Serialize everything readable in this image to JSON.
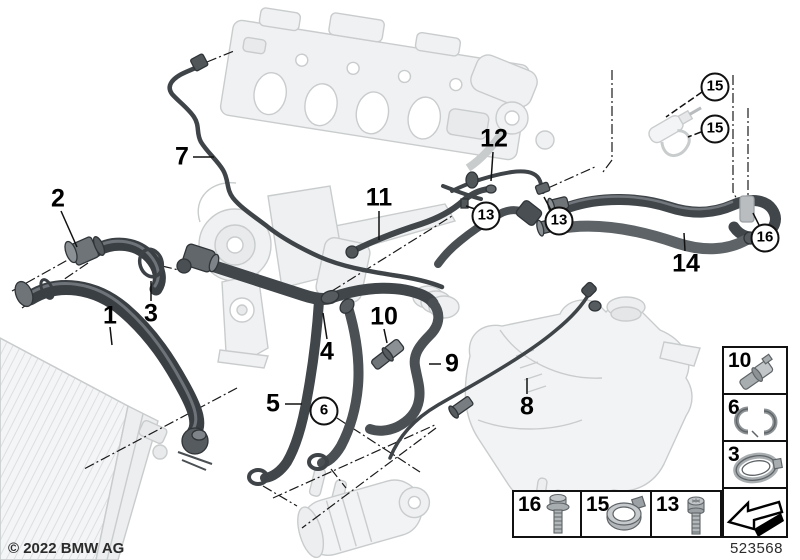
{
  "diagram": {
    "copyright": "© 2022 BMW AG",
    "drawing_number": "523568",
    "callouts": [
      {
        "label": "1",
        "x": 110,
        "y": 316,
        "circled": false
      },
      {
        "label": "2",
        "x": 58,
        "y": 199,
        "circled": false
      },
      {
        "label": "3",
        "x": 151,
        "y": 314,
        "circled": false
      },
      {
        "label": "4",
        "x": 327,
        "y": 352,
        "circled": false
      },
      {
        "label": "5",
        "x": 273,
        "y": 404,
        "circled": false
      },
      {
        "label": "6",
        "x": 324,
        "y": 411,
        "circled": true
      },
      {
        "label": "7",
        "x": 182,
        "y": 157,
        "circled": false
      },
      {
        "label": "8",
        "x": 527,
        "y": 407,
        "circled": false
      },
      {
        "label": "9",
        "x": 452,
        "y": 364,
        "circled": false
      },
      {
        "label": "10",
        "x": 384,
        "y": 317,
        "circled": false
      },
      {
        "label": "11",
        "x": 379,
        "y": 198,
        "circled": false
      },
      {
        "label": "12",
        "x": 494,
        "y": 139,
        "circled": false
      },
      {
        "label": "13",
        "x": 486,
        "y": 216,
        "circled": true
      },
      {
        "label": "13",
        "x": 559,
        "y": 221,
        "circled": true
      },
      {
        "label": "14",
        "x": 686,
        "y": 264,
        "circled": false
      },
      {
        "label": "15",
        "x": 715,
        "y": 87,
        "circled": true
      },
      {
        "label": "15",
        "x": 715,
        "y": 129,
        "circled": true
      },
      {
        "label": "16",
        "x": 765,
        "y": 238,
        "circled": true
      }
    ],
    "legend_right": [
      {
        "label": "10",
        "icon": "quick-connect-coupling-icon"
      },
      {
        "label": "6",
        "icon": "retaining-clip-icon"
      },
      {
        "label": "3",
        "icon": "band-clamp-icon"
      },
      {
        "label": "",
        "icon": "continuation-arrow-icon"
      }
    ],
    "legend_bottom": [
      {
        "label": "16",
        "icon": "flange-bolt-icon"
      },
      {
        "label": "15",
        "icon": "hose-clamp-icon"
      },
      {
        "label": "13",
        "icon": "socket-screw-icon"
      }
    ],
    "colors": {
      "hose_dark": "#41464b",
      "hose_mid": "#5d6367",
      "machinery_faint": "#c9cccd",
      "line": "#1a1a1a"
    }
  }
}
